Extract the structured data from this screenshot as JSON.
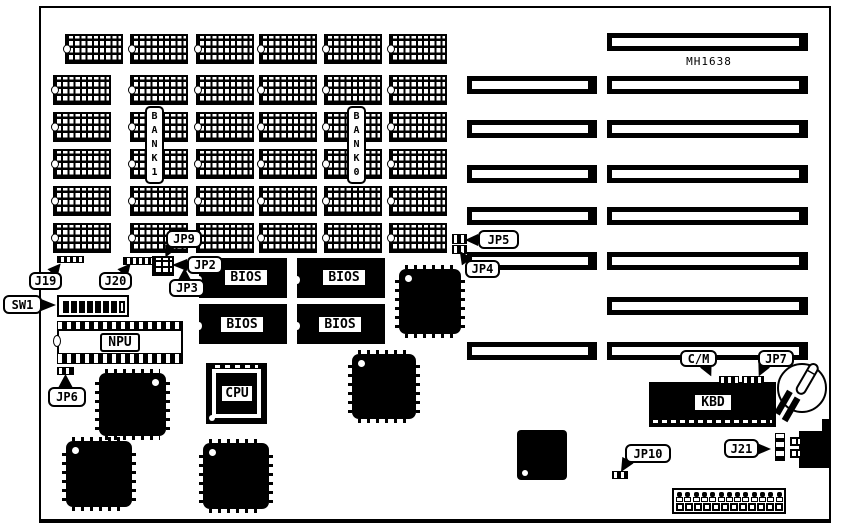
{
  "diagram": {
    "board_id": "MH1638",
    "banks": {
      "bank1": "BANK1",
      "bank0": "BANK0"
    },
    "chip_labels": {
      "bios": "BIOS",
      "npu": "NPU",
      "cpu": "CPU",
      "kbd": "KBD"
    },
    "callouts": {
      "j19": "J19",
      "j20": "J20",
      "jp9": "JP9",
      "jp2": "JP2",
      "jp3": "JP3",
      "jp4": "JP4",
      "jp5": "JP5",
      "sw1": "SW1",
      "jp6": "JP6",
      "cm": "C/M",
      "jp7": "JP7",
      "jp10": "JP10",
      "j21": "J21"
    }
  }
}
